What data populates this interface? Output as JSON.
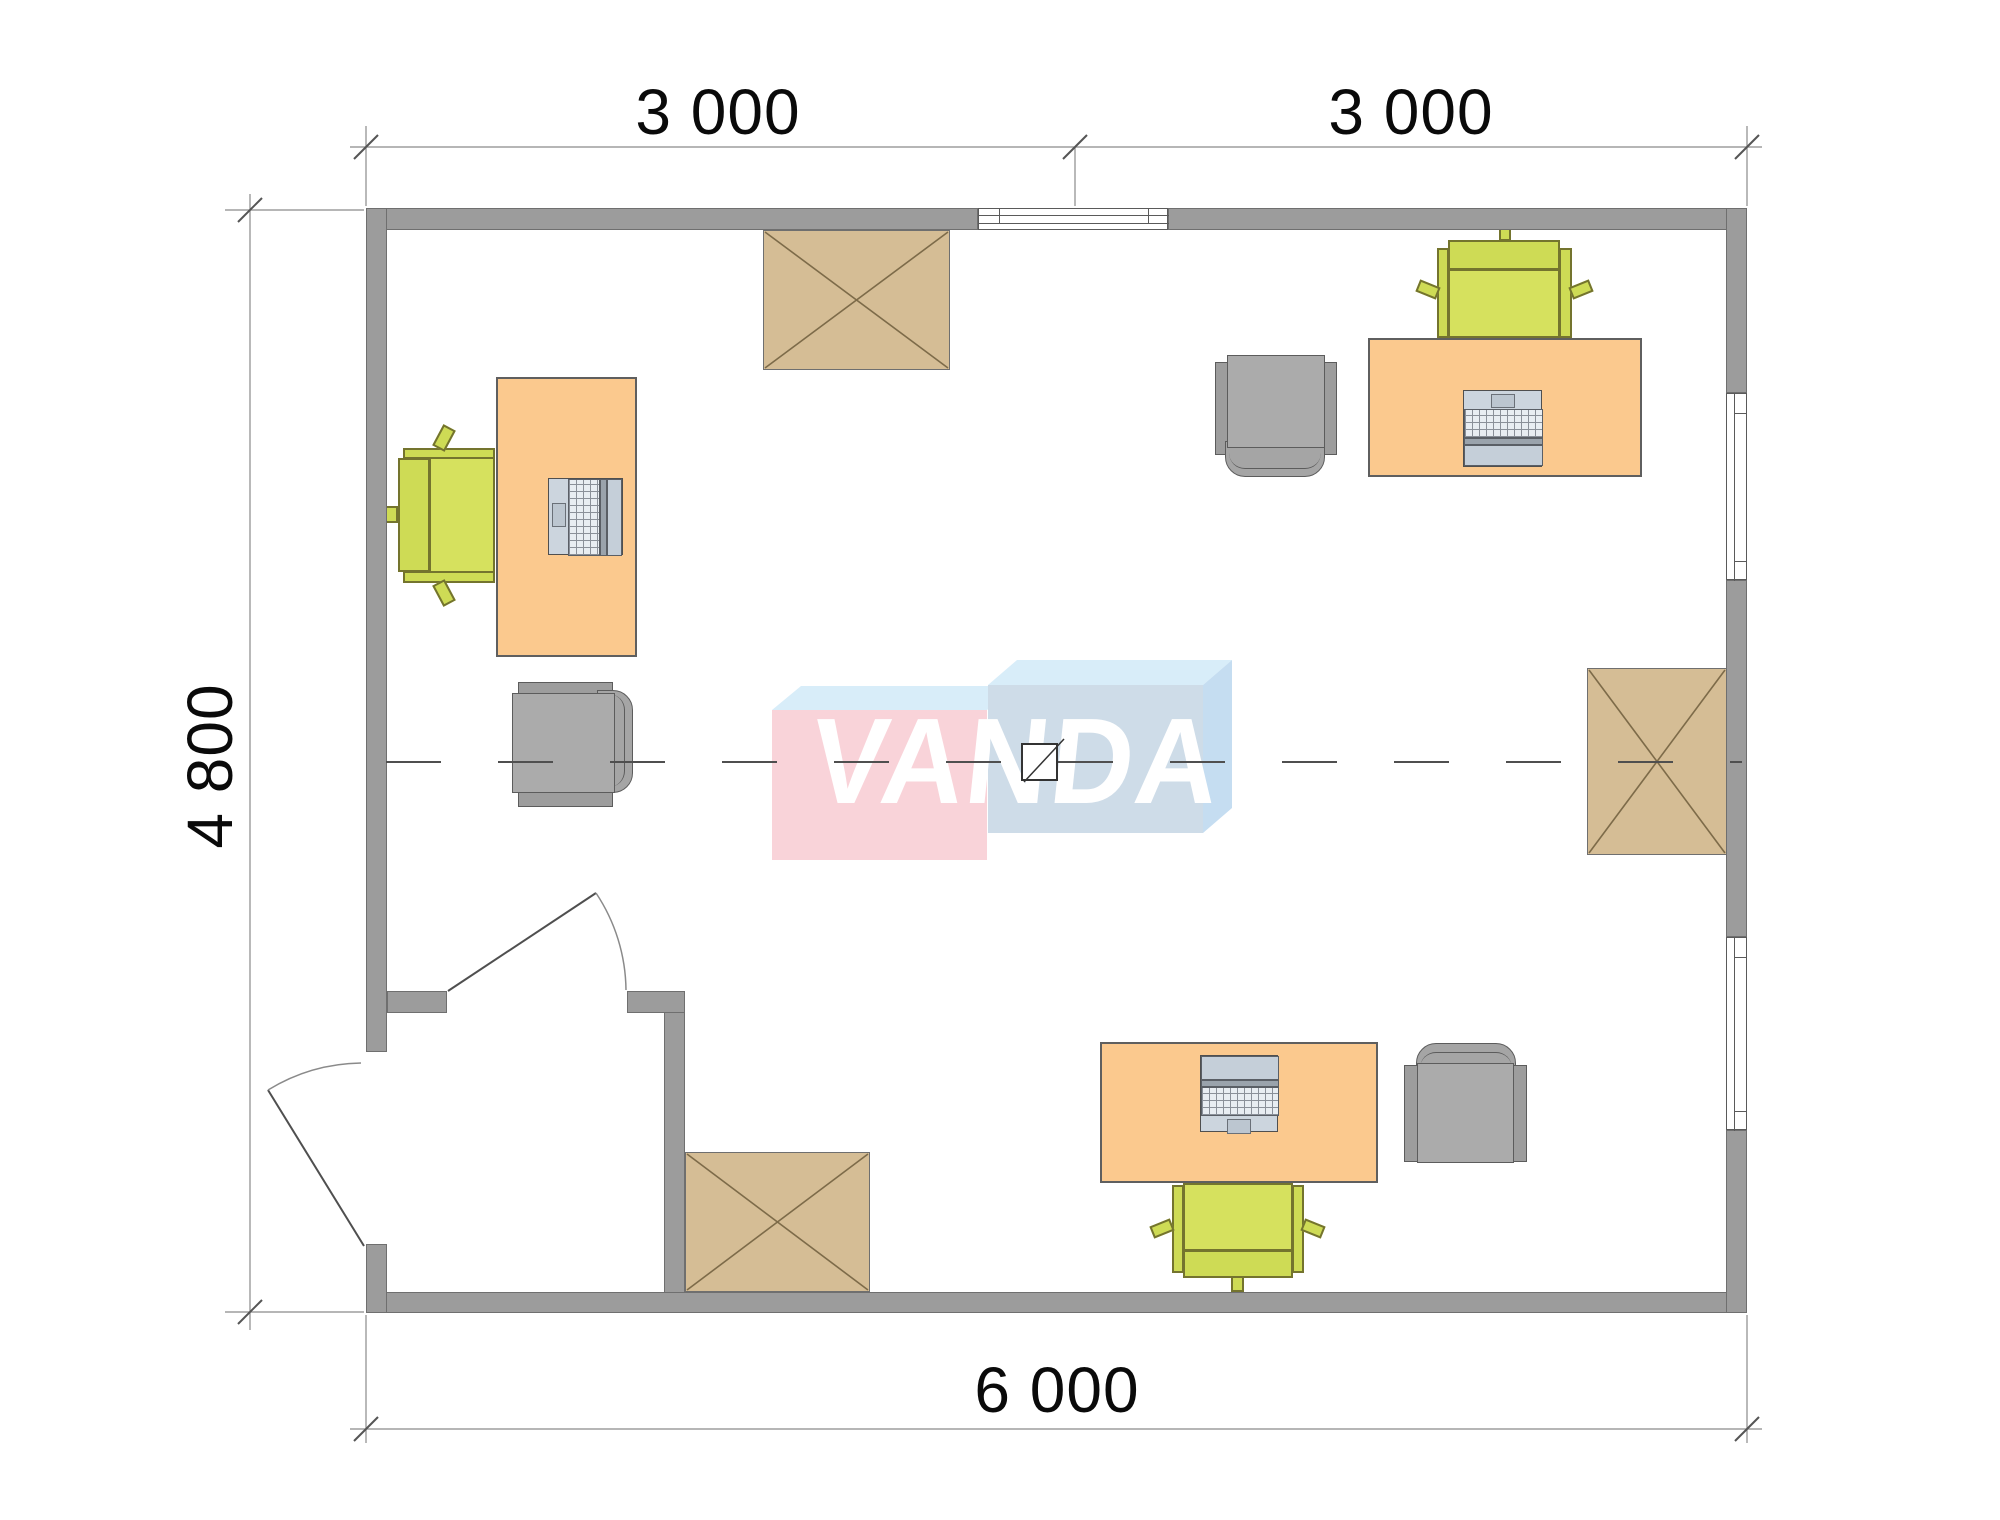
{
  "plan": {
    "type": "office floor plan, top view",
    "dimensions": {
      "top_left": "3 000",
      "top_right": "3 000",
      "left": "4 800",
      "bottom": "6 000"
    },
    "watermark": {
      "text": "VANDA"
    },
    "colors": {
      "wall": "#9c9c9c",
      "desk": "#fbc98e",
      "cabinet": "#d5bd95",
      "cabinet_cross": "#7d6b49",
      "task_chair_green": "#d6e15e",
      "armchair_gray": "#ababab",
      "laptop_body": "#ccd5de",
      "logo_pink": "#f9d3d9",
      "logo_blue_front": "#cedce8",
      "logo_blue_top": "#d8edf9",
      "logo_blue_side": "#c5ddf1",
      "centerline": "#4f4f4f"
    },
    "inventory": {
      "desks_with_laptops": 3,
      "green_task_chairs": 3,
      "gray_armchairs": 3,
      "crossed_cabinets": 3,
      "windows": 3,
      "doors": 2
    }
  }
}
